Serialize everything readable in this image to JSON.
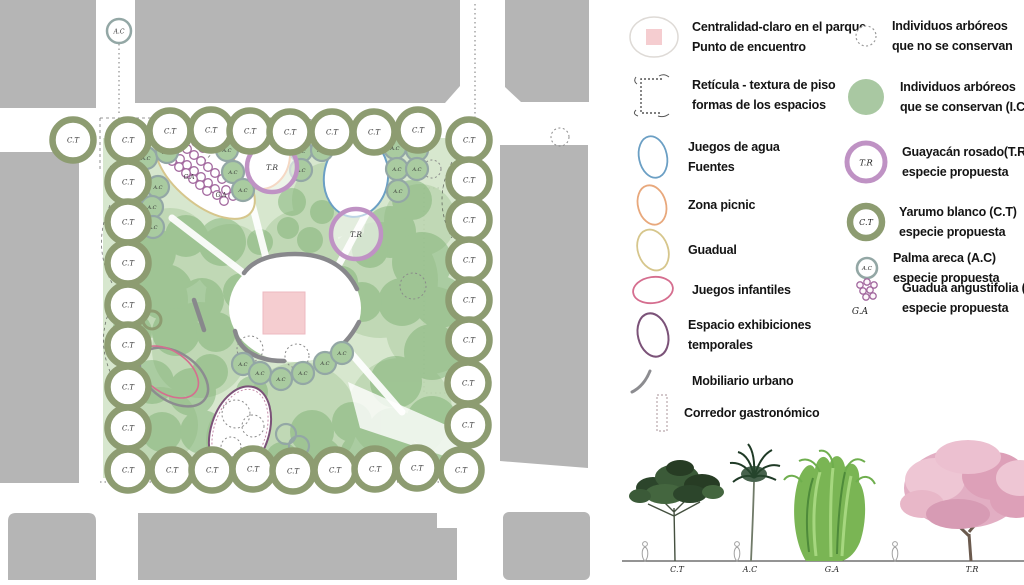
{
  "colors": {
    "building": "#b5b5b5",
    "park_green": "#c9dfbd",
    "blob_green": "#7fb275",
    "ct_ring": "#8d9c71",
    "ac_ring": "#93a7a5",
    "ac_fill": "#a9cba0",
    "tr_ring": "#bf92c4",
    "ga_stroke": "#a3699f",
    "conserved_fill": "#a9c8a2",
    "water": "#6b9fc4",
    "picnic": "#e8a87c",
    "guadual": "#d6c68c",
    "playground": "#d56e8f",
    "exhibitions": "#7b5278",
    "furniture": "#8c8c90",
    "plaza_pink": "#f5cdd0"
  },
  "plan": {
    "species": {
      "ct": "C.T",
      "ac": "A.C",
      "tr": "T.R",
      "ga": "G.A"
    },
    "ct": [
      [
        73,
        140
      ],
      [
        170,
        131
      ],
      [
        211,
        130
      ],
      [
        250,
        131
      ],
      [
        290,
        132
      ],
      [
        332,
        132
      ],
      [
        374,
        132
      ],
      [
        418,
        130
      ],
      [
        128,
        140
      ],
      [
        128,
        182
      ],
      [
        128,
        222
      ],
      [
        128,
        263
      ],
      [
        128,
        305
      ],
      [
        128,
        345
      ],
      [
        128,
        387
      ],
      [
        128,
        428
      ],
      [
        128,
        470
      ],
      [
        469,
        140
      ],
      [
        469,
        180
      ],
      [
        469,
        220
      ],
      [
        469,
        260
      ],
      [
        469,
        300
      ],
      [
        469,
        340
      ],
      [
        468,
        383
      ],
      [
        468,
        425
      ],
      [
        461,
        470
      ],
      [
        172,
        470
      ],
      [
        212,
        470
      ],
      [
        253,
        469
      ],
      [
        293,
        471
      ],
      [
        335,
        470
      ],
      [
        375,
        469
      ],
      [
        417,
        468
      ]
    ],
    "ac": [
      [
        146,
        158
      ],
      [
        167,
        152
      ],
      [
        158,
        187
      ],
      [
        152,
        207
      ],
      [
        153,
        227
      ],
      [
        227,
        150
      ],
      [
        233,
        172
      ],
      [
        243,
        190
      ],
      [
        301,
        151
      ],
      [
        301,
        170
      ],
      [
        322,
        150
      ],
      [
        395,
        148
      ],
      [
        417,
        150
      ],
      [
        397,
        169
      ],
      [
        417,
        169
      ],
      [
        398,
        191
      ],
      [
        243,
        364
      ],
      [
        260,
        373
      ],
      [
        281,
        379
      ],
      [
        303,
        373
      ],
      [
        325,
        363
      ],
      [
        342,
        353
      ]
    ],
    "ac_street": [
      [
        119,
        31
      ]
    ],
    "tr": [
      [
        272,
        167
      ],
      [
        356,
        234
      ]
    ],
    "ga_circles": [
      [
        166,
        147
      ],
      [
        173,
        153
      ],
      [
        180,
        159
      ],
      [
        187,
        165
      ],
      [
        194,
        171
      ],
      [
        201,
        177
      ],
      [
        208,
        183
      ],
      [
        215,
        189
      ],
      [
        180,
        143
      ],
      [
        187,
        149
      ],
      [
        194,
        155
      ],
      [
        201,
        161
      ],
      [
        208,
        167
      ],
      [
        215,
        173
      ],
      [
        222,
        179
      ],
      [
        172,
        161
      ],
      [
        179,
        167
      ],
      [
        186,
        173
      ],
      [
        193,
        179
      ],
      [
        200,
        185
      ],
      [
        207,
        191
      ],
      [
        196,
        142
      ],
      [
        203,
        148
      ],
      [
        226,
        190
      ],
      [
        233,
        196
      ],
      [
        224,
        201
      ],
      [
        217,
        195
      ]
    ],
    "ga_labels": [
      [
        171,
        152
      ],
      [
        208,
        152
      ],
      [
        189,
        179
      ],
      [
        221,
        197
      ]
    ],
    "removed_trees": [
      [
        250,
        349,
        13
      ],
      [
        297,
        356,
        12
      ],
      [
        413,
        286,
        13
      ],
      [
        432,
        169,
        9
      ],
      [
        236,
        414,
        14
      ],
      [
        253,
        426,
        11
      ],
      [
        231,
        447,
        10
      ],
      [
        244,
        462,
        12
      ],
      [
        560,
        137,
        9
      ]
    ],
    "small_rings_olive": [
      [
        271,
        130,
        11
      ],
      [
        152,
        320,
        9
      ]
    ],
    "small_rings_teal": [
      [
        286,
        434,
        10
      ],
      [
        299,
        446,
        10
      ]
    ],
    "zones": [
      {
        "id": "claro-central",
        "c": [
          295,
          308
        ],
        "rx": 66,
        "ry": 54,
        "rot": 0,
        "stroke": "none",
        "w": 0,
        "fill": "#ffffff"
      },
      {
        "id": "guadual",
        "c": [
          205,
          174
        ],
        "rx": 60,
        "ry": 30,
        "rot": 40,
        "stroke": "#d6c68c",
        "w": 2,
        "fill": "#ffffff"
      },
      {
        "id": "zona-picnic",
        "c": [
          262,
          155
        ],
        "rx": 28,
        "ry": 34,
        "rot": 5,
        "stroke": "#e8a87c",
        "w": 2,
        "fill": "#ffffff"
      },
      {
        "id": "juegos-de-agua",
        "c": [
          356,
          177
        ],
        "rx": 32,
        "ry": 40,
        "rot": 8,
        "stroke": "#6b9fc4",
        "w": 2,
        "fill": "#ffffff"
      },
      {
        "id": "mobiliario-ellipse",
        "c": [
          174,
          377
        ],
        "rx": 38,
        "ry": 24,
        "rot": 35,
        "stroke": "#8c8c90",
        "w": 2.5,
        "fill": "none"
      },
      {
        "id": "juegos-infantiles",
        "c": [
          168,
          372
        ],
        "rx": 34,
        "ry": 21,
        "rot": 35,
        "stroke": "#d56e8f",
        "w": 1.6,
        "fill": "none"
      },
      {
        "id": "exhibiciones",
        "c": [
          240,
          431
        ],
        "rx": 29,
        "ry": 46,
        "rot": 18,
        "stroke": "#7b5278",
        "w": 2,
        "fill": "#ffffff"
      }
    ]
  },
  "legend": {
    "left": [
      {
        "icon": "centrality-icon",
        "lines": [
          "Centralidad-claro en el parque",
          "Punto de encuentro"
        ]
      },
      {
        "icon": "grid-texture-icon",
        "lines": [
          "Retícula - textura de piso",
          "formas de los espacios"
        ]
      },
      {
        "icon": "water-games-icon",
        "lines": [
          "Juegos de agua",
          "Fuentes"
        ]
      },
      {
        "icon": "picnic-zone-icon",
        "lines": [
          "Zona picnic"
        ]
      },
      {
        "icon": "guadual-icon",
        "lines": [
          "Guadual"
        ]
      },
      {
        "icon": "playground-icon",
        "lines": [
          "Juegos infantiles"
        ]
      },
      {
        "icon": "exhibitions-icon",
        "lines": [
          "Espacio exhibiciones",
          "temporales"
        ]
      },
      {
        "icon": "urban-furniture-icon",
        "lines": [
          "Mobiliario urbano"
        ]
      },
      {
        "icon": "gastronomic-corridor-icon",
        "lines": [
          "Corredor gastronómico"
        ]
      }
    ],
    "right": [
      {
        "icon": "tree-not-conserved-icon",
        "lines": [
          "Individuos arbóreos",
          "que no se conservan"
        ]
      },
      {
        "icon": "tree-conserved-icon",
        "lines": [
          "Individuos arbóreos",
          "que se conservan (I.C)"
        ]
      },
      {
        "icon": "tr-ring-icon",
        "symbol": "T.R",
        "lines": [
          "Guayacán rosado(T.R)",
          "especie propuesta"
        ]
      },
      {
        "icon": "ct-ring-icon",
        "symbol": "C.T",
        "lines": [
          "Yarumo blanco (C.T)",
          "especie propuesta"
        ]
      },
      {
        "icon": "ac-ring-icon",
        "symbol": "A.C",
        "lines": [
          "Palma areca (A.C)",
          "especie propuesta"
        ]
      },
      {
        "icon": "ga-cluster-icon",
        "symbol": "G.A",
        "lines": [
          "Guadua angustifolia (G.A)",
          "especie propuesta"
        ]
      }
    ]
  },
  "elevation": {
    "labels": [
      "C.T",
      "A.C",
      "G.A",
      "T.R"
    ]
  }
}
